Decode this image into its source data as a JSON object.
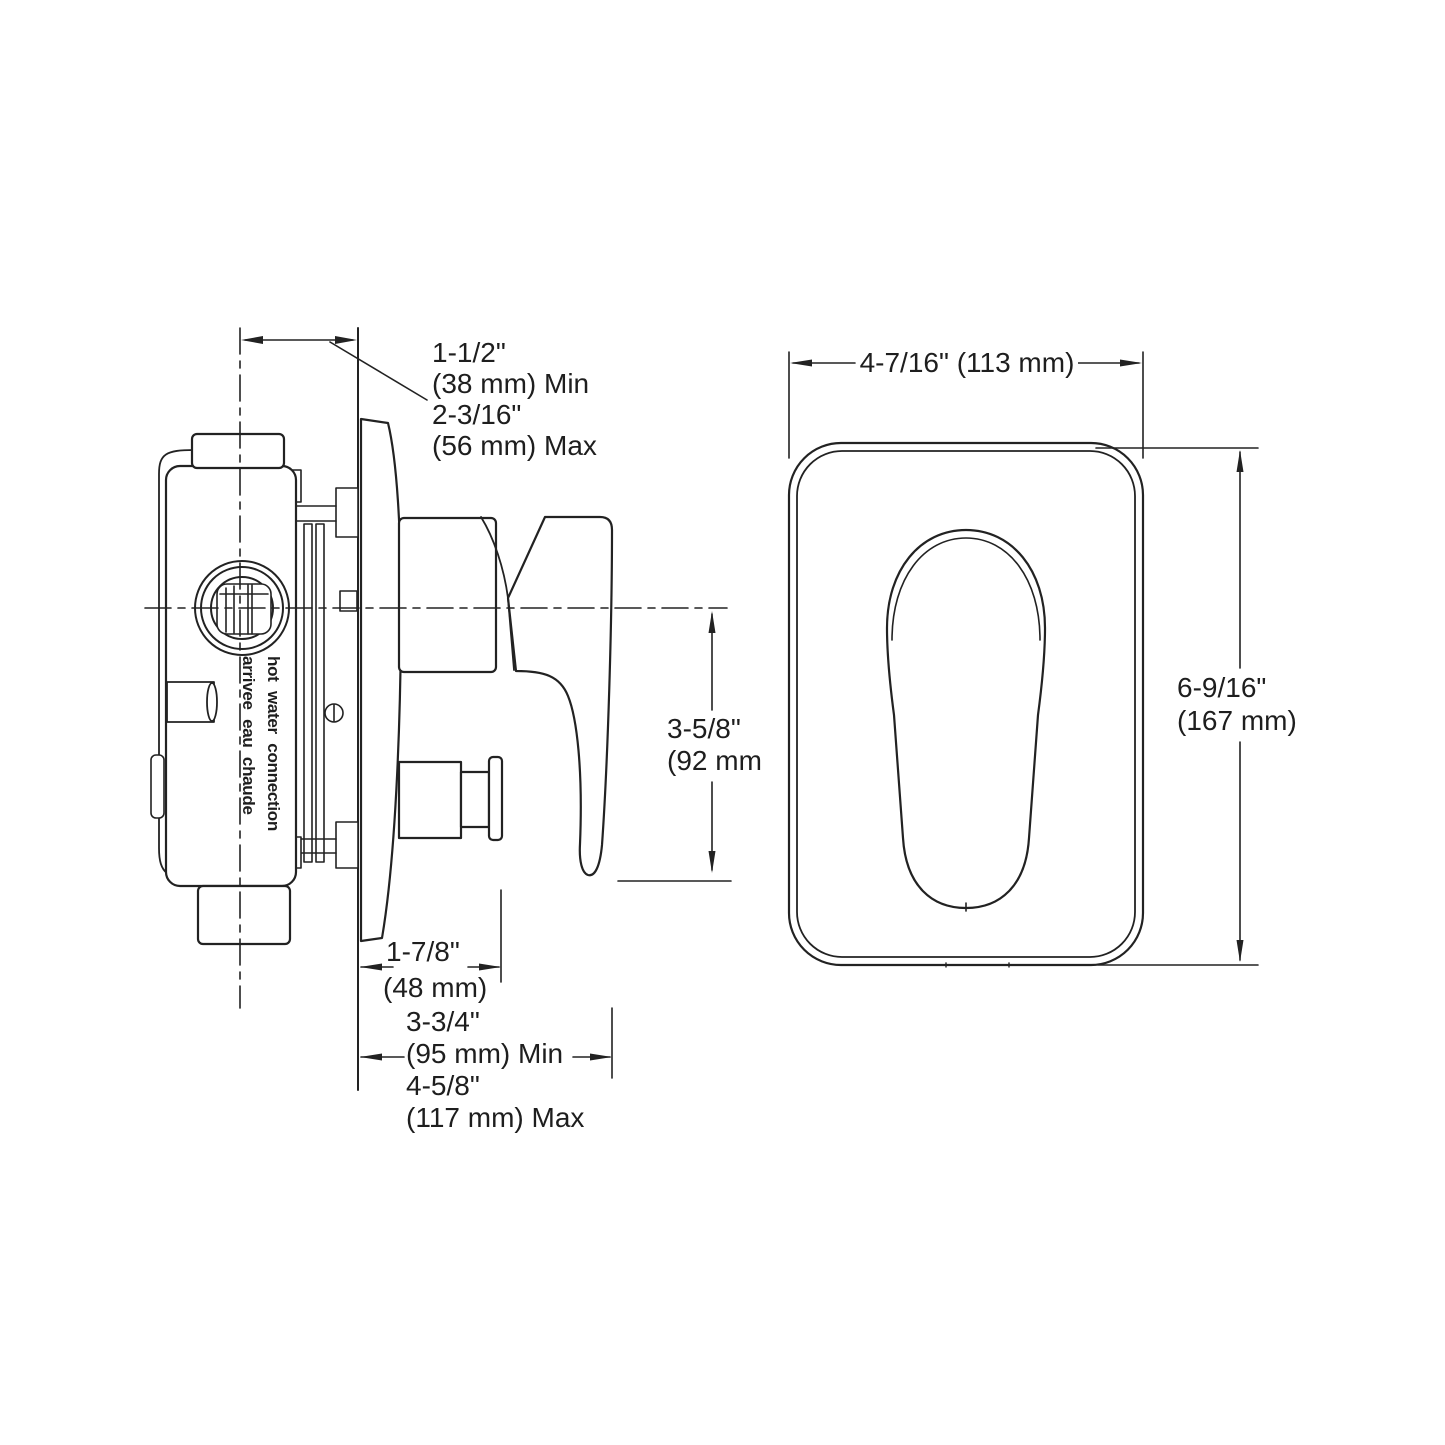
{
  "drawing": {
    "background": "#ffffff",
    "line_color": "#222222",
    "side_view": {
      "port_label": {
        "line1": "hot water connection",
        "line2": "arrivee eau chaude"
      },
      "dim_wall_depth": {
        "lines": [
          "1-1/2\"",
          "(38 mm) Min",
          "2-3/16\"",
          "(56 mm) Max"
        ]
      },
      "dim_handle_drop": {
        "lines": [
          "3-5/8\"",
          "(92 mm"
        ]
      },
      "dim_button_projection": {
        "lines": [
          "1-7/8\"",
          "(48 mm)"
        ]
      },
      "dim_handle_projection": {
        "lines": [
          "3-3/4\"",
          "(95 mm) Min",
          "4-5/8\"",
          "(117 mm) Max"
        ]
      }
    },
    "front_view": {
      "dim_plate_width": "4-7/16\" (113 mm)",
      "dim_plate_height": {
        "lines": [
          "6-9/16\"",
          "(167 mm)"
        ]
      }
    }
  }
}
